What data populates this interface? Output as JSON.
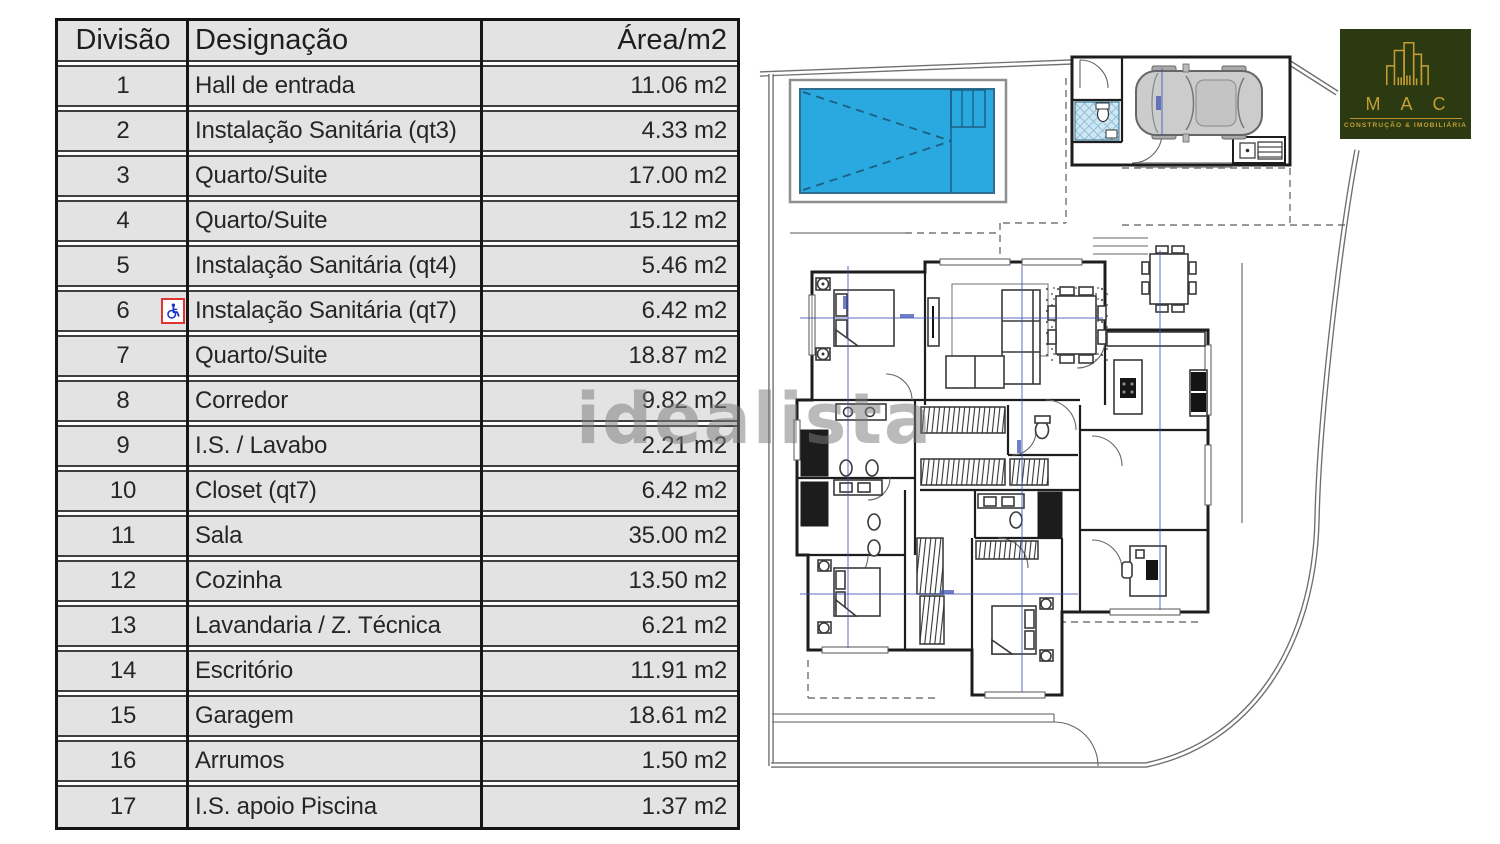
{
  "table": {
    "headers": {
      "division": "Divisão",
      "designation": "Designação",
      "area": "Área/m2"
    },
    "rows": [
      {
        "division": "1",
        "designation": "Hall de entrada",
        "area": "11.06 m2",
        "accessible": false
      },
      {
        "division": "2",
        "designation": "Instalação Sanitária (qt3)",
        "area": "4.33 m2",
        "accessible": false
      },
      {
        "division": "3",
        "designation": "Quarto/Suite",
        "area": "17.00 m2",
        "accessible": false
      },
      {
        "division": "4",
        "designation": "Quarto/Suite",
        "area": "15.12 m2",
        "accessible": false
      },
      {
        "division": "5",
        "designation": "Instalação Sanitária (qt4)",
        "area": "5.46 m2",
        "accessible": false
      },
      {
        "division": "6",
        "designation": "Instalação Sanitária (qt7)",
        "area": "6.42 m2",
        "accessible": true
      },
      {
        "division": "7",
        "designation": "Quarto/Suite",
        "area": "18.87 m2",
        "accessible": false
      },
      {
        "division": "8",
        "designation": "Corredor",
        "area": "9.82 m2",
        "accessible": false
      },
      {
        "division": "9",
        "designation": "I.S. / Lavabo",
        "area": "2.21 m2",
        "accessible": false
      },
      {
        "division": "10",
        "designation": "Closet (qt7)",
        "area": "6.42 m2",
        "accessible": false
      },
      {
        "division": "11",
        "designation": "Sala",
        "area": "35.00 m2",
        "accessible": false
      },
      {
        "division": "12",
        "designation": "Cozinha",
        "area": "13.50 m2",
        "accessible": false
      },
      {
        "division": "13",
        "designation": "Lavandaria / Z. Técnica",
        "area": "6.21 m2",
        "accessible": false
      },
      {
        "division": "14",
        "designation": "Escritório",
        "area": "11.91 m2",
        "accessible": false
      },
      {
        "division": "15",
        "designation": "Garagem",
        "area": "18.61 m2",
        "accessible": false
      },
      {
        "division": "16",
        "designation": "Arrumos",
        "area": "1.50 m2",
        "accessible": false
      },
      {
        "division": "17",
        "designation": "I.S. apoio Piscina",
        "area": "1.37 m2",
        "accessible": false
      }
    ]
  },
  "floorplan": {
    "pool_color": "#29a9df",
    "wc_hatch_color": "#cfe7f3",
    "dimension_line_color": "#4053b3",
    "wall_color": "#1d1d1d"
  },
  "watermark": {
    "text": "idealista"
  },
  "logo": {
    "brand": "M A C",
    "tagline": "CONSTRUÇÃO & IMOBILIÁRIA",
    "background_color": "#2c3a12",
    "accent_color": "#c59d33"
  }
}
